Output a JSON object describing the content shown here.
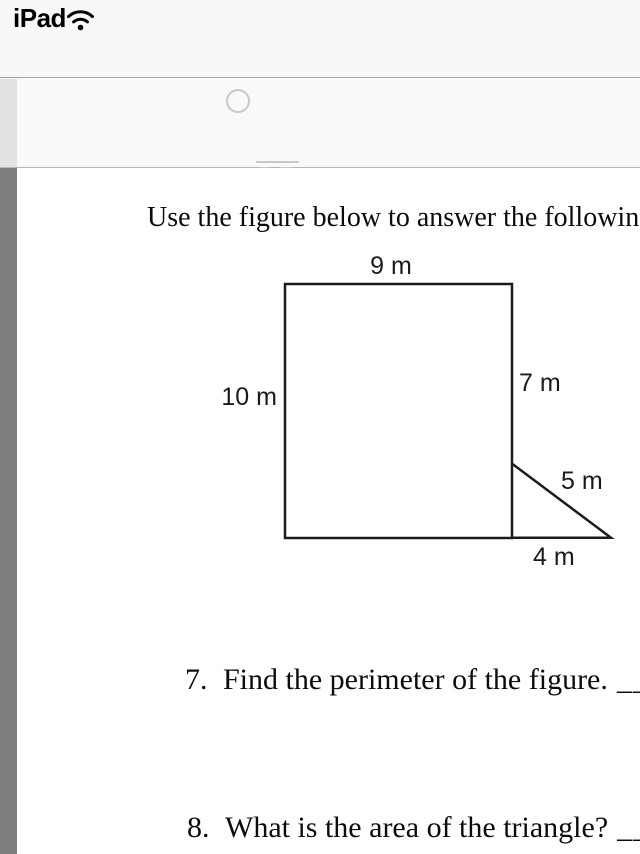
{
  "status_bar": {
    "device_label": "iPad",
    "wifi_icon": "wifi-icon"
  },
  "choice_row": {
    "option_label": "DB",
    "option_has_overline": true,
    "radio_selected": false
  },
  "worksheet": {
    "instruction": "Use the figure below to answer the following",
    "figure": {
      "shape": "rectangle with right triangle attached at lower right",
      "top_label": "9 m",
      "left_label": "10 m",
      "right_label": "7 m",
      "hypotenuse_label": "5 m",
      "base_label": "4 m"
    },
    "questions": [
      {
        "number": "7.",
        "text": "Find the perimeter of the figure.",
        "blank": "______"
      },
      {
        "number": "8.",
        "text": "What is the area of the triangle?",
        "blank": "______"
      }
    ]
  },
  "colors": {
    "status_bar_bg": "#f8f8f8",
    "choice_row_bg": "#f9f9f9",
    "light_strip": "#e2e2e2",
    "dark_strip": "#7e7e7e",
    "divider_top": "#9e9e9e",
    "divider_bottom": "#b6b6b6",
    "muted_option": "#c9c9c9",
    "figure_stroke": "#1c1c1c",
    "text": "#0c0c0c"
  }
}
